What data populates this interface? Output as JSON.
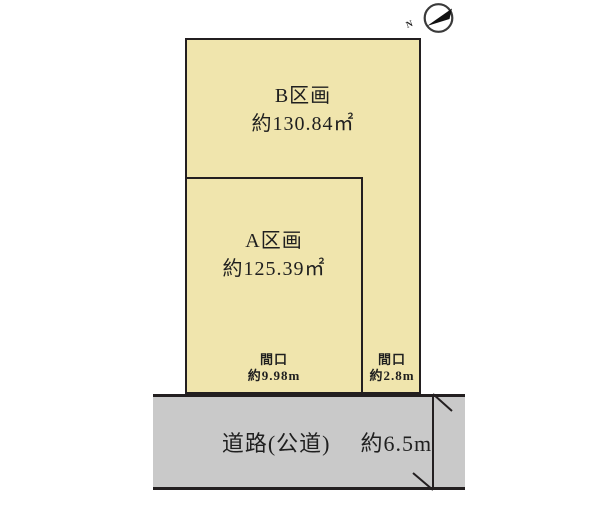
{
  "compass": {
    "north_label": "N"
  },
  "plots": [
    {
      "name": "B区画",
      "area": "約130.84㎡"
    },
    {
      "name": "A区画",
      "area": "約125.39㎡"
    }
  ],
  "frontages": [
    {
      "label": "間口",
      "value": "約9.98m"
    },
    {
      "label": "間口",
      "value": "約2.8m"
    }
  ],
  "road": {
    "label": "道路(公道)",
    "width": "約6.5m"
  },
  "colors": {
    "plot_fill": "#F0E5AD",
    "road_fill": "#C9C9C9",
    "line": "#231F20"
  }
}
